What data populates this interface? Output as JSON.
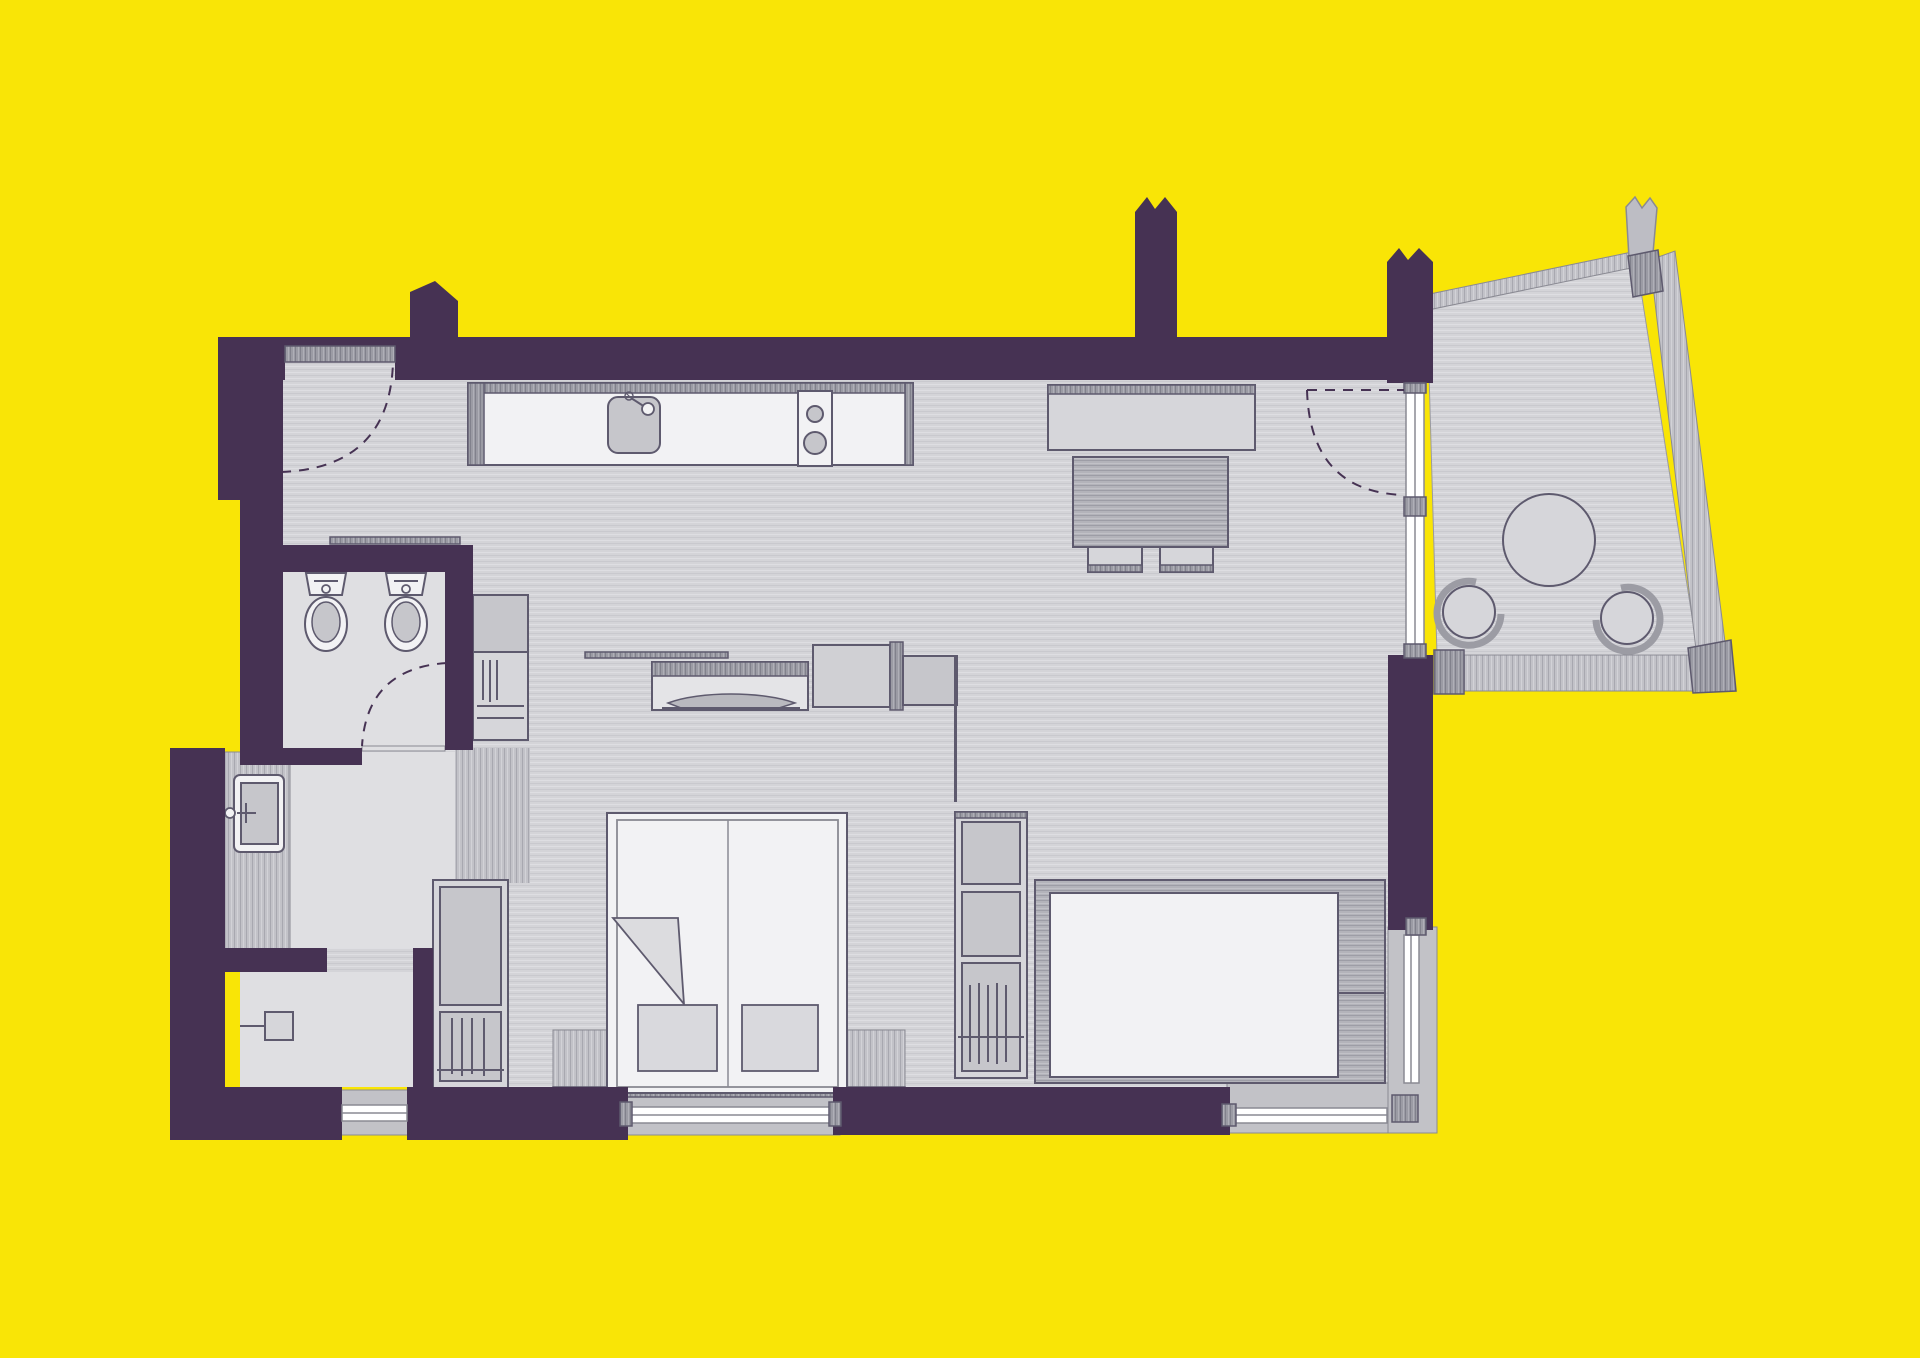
{
  "scene": {
    "type": "apartment-floor-plan",
    "view": "top-down architectural drawing",
    "text_visible": "none"
  },
  "palette": {
    "background": "#F9E506",
    "wall": "#463253",
    "outline": "#5E5A6E",
    "outline_soft": "#8A8A93",
    "floor_light": "#DFDFE2",
    "furniture_white": "#F2F2F4",
    "furniture_gray": "#C6C6CB",
    "furniture_gray_light": "#D6D6DA",
    "window_sill": "#C2C2C7",
    "glazing": "#FFFFFF"
  },
  "rooms": [
    {
      "name": "entry-hall",
      "floor": "wood-grain gray"
    },
    {
      "name": "kitchen-dining-living",
      "floor": "wood-grain gray"
    },
    {
      "name": "bathroom",
      "floor": "plain light gray",
      "fixtures": [
        "toilet",
        "bidet"
      ]
    },
    {
      "name": "washbasin-alcove",
      "floor": "plain light gray",
      "fixtures": [
        "washbasin-counter"
      ]
    },
    {
      "name": "shower-room",
      "floor": "plain light gray",
      "fixtures": [
        "shower-fitting",
        "window"
      ]
    },
    {
      "name": "bedroom-area",
      "floor": "wood-grain gray",
      "fixtures": [
        "double-bed",
        "wardrobes",
        "window"
      ]
    },
    {
      "name": "balcony",
      "shape": "trapezoid",
      "fixtures": [
        "round-table",
        "round-chair",
        "round-chair"
      ]
    }
  ],
  "furniture": [
    "entrance-door-swing",
    "kitchen-counter",
    "kitchen-sink",
    "cooktop-2-burners",
    "sideboard",
    "dining-table",
    "dining-chair",
    "dining-chair",
    "balcony-glazed-door-swing",
    "balcony-round-table",
    "balcony-round-chair",
    "balcony-round-chair",
    "toilet",
    "bidet",
    "bathroom-door-swing",
    "washbasin",
    "shower-fitting",
    "tall-cabinet",
    "hanging-closet",
    "wardrobe-left",
    "wardrobe-right",
    "wall-shelf",
    "desk-with-laptop",
    "partition-cabinets",
    "double-bed",
    "pillow",
    "pillow",
    "folded-blanket",
    "bed-side-benches",
    "sofa-daybed",
    "window-shower",
    "window-bedroom",
    "window-living-bottom",
    "window-living-right"
  ],
  "annotations": [
    "wall-break-symbol-top",
    "wall-break-symbol-balcony",
    "wall-spike-protrusion"
  ]
}
